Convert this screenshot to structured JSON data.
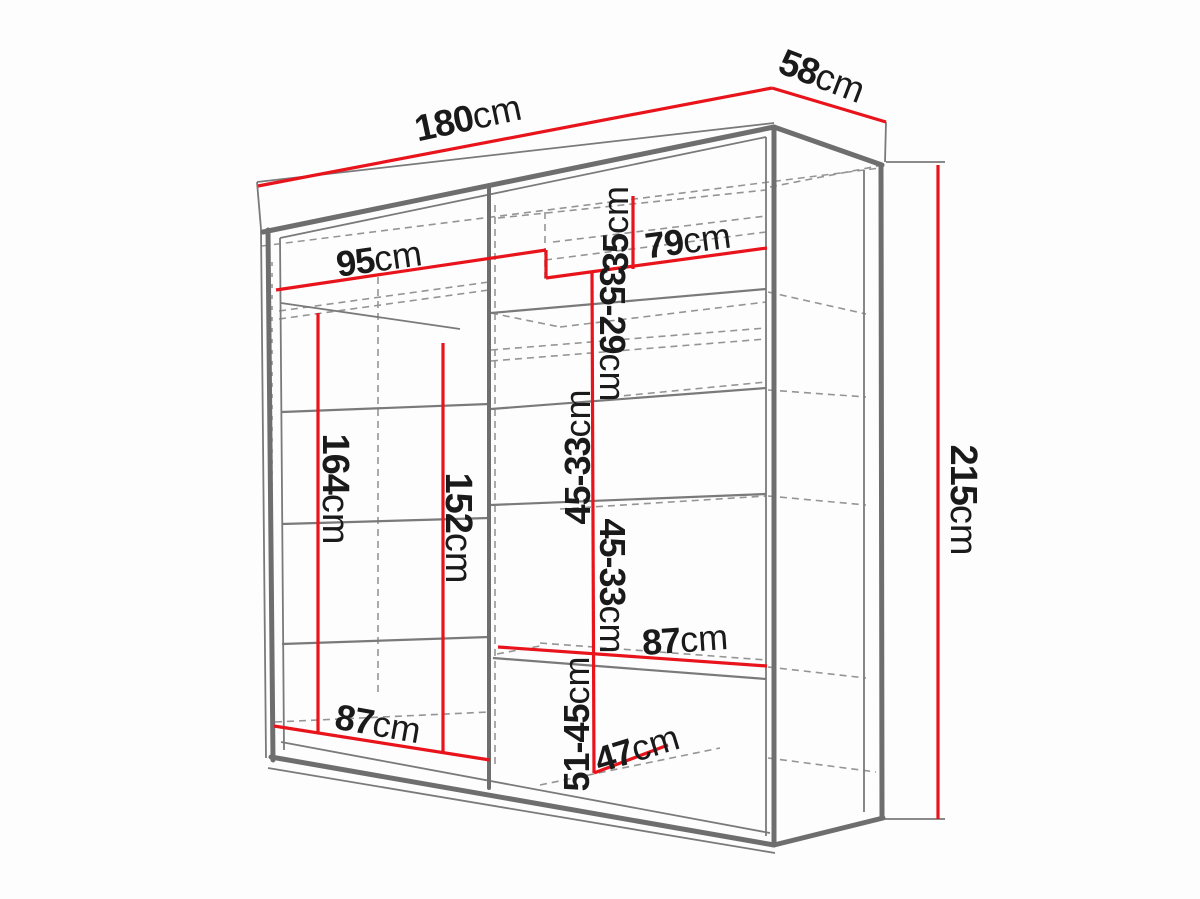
{
  "diagram": {
    "kind": "wardrobe-dimension-drawing",
    "description": "3D line drawing of a two-door sliding wardrobe with internal shelf layout and red dimension lines",
    "unit": "cm",
    "colors": {
      "dimension_line": "#e8131b",
      "edge_line": "#6e6e6e",
      "hidden_line": "#959595",
      "label_text": "#1a1a1a",
      "background": "#fdfdfd"
    },
    "dimensions": {
      "total_width": {
        "num": "180",
        "unit": "cm"
      },
      "total_depth": {
        "num": "58",
        "unit": "cm"
      },
      "total_height": {
        "num": "215",
        "unit": "cm"
      },
      "top_shelf_left": {
        "num": "95",
        "unit": "cm"
      },
      "top_shelf_right": {
        "num": "79",
        "unit": "cm"
      },
      "top_section": {
        "num": "35",
        "unit": "cm"
      },
      "upper_right_section": {
        "num": "35-29",
        "unit": "cm"
      },
      "left_hanging_height": {
        "num": "164",
        "unit": "cm"
      },
      "mid_hanging_height": {
        "num": "152",
        "unit": "cm"
      },
      "right_section_a": {
        "num": "45-33",
        "unit": "cm"
      },
      "right_section_b": {
        "num": "45-33",
        "unit": "cm"
      },
      "right_shelf_width": {
        "num": "87",
        "unit": "cm"
      },
      "left_shelf_width": {
        "num": "87",
        "unit": "cm"
      },
      "bottom_right_section": {
        "num": "51-45",
        "unit": "cm"
      },
      "bottom_shelf_depth": {
        "num": "47",
        "unit": "cm"
      }
    }
  }
}
